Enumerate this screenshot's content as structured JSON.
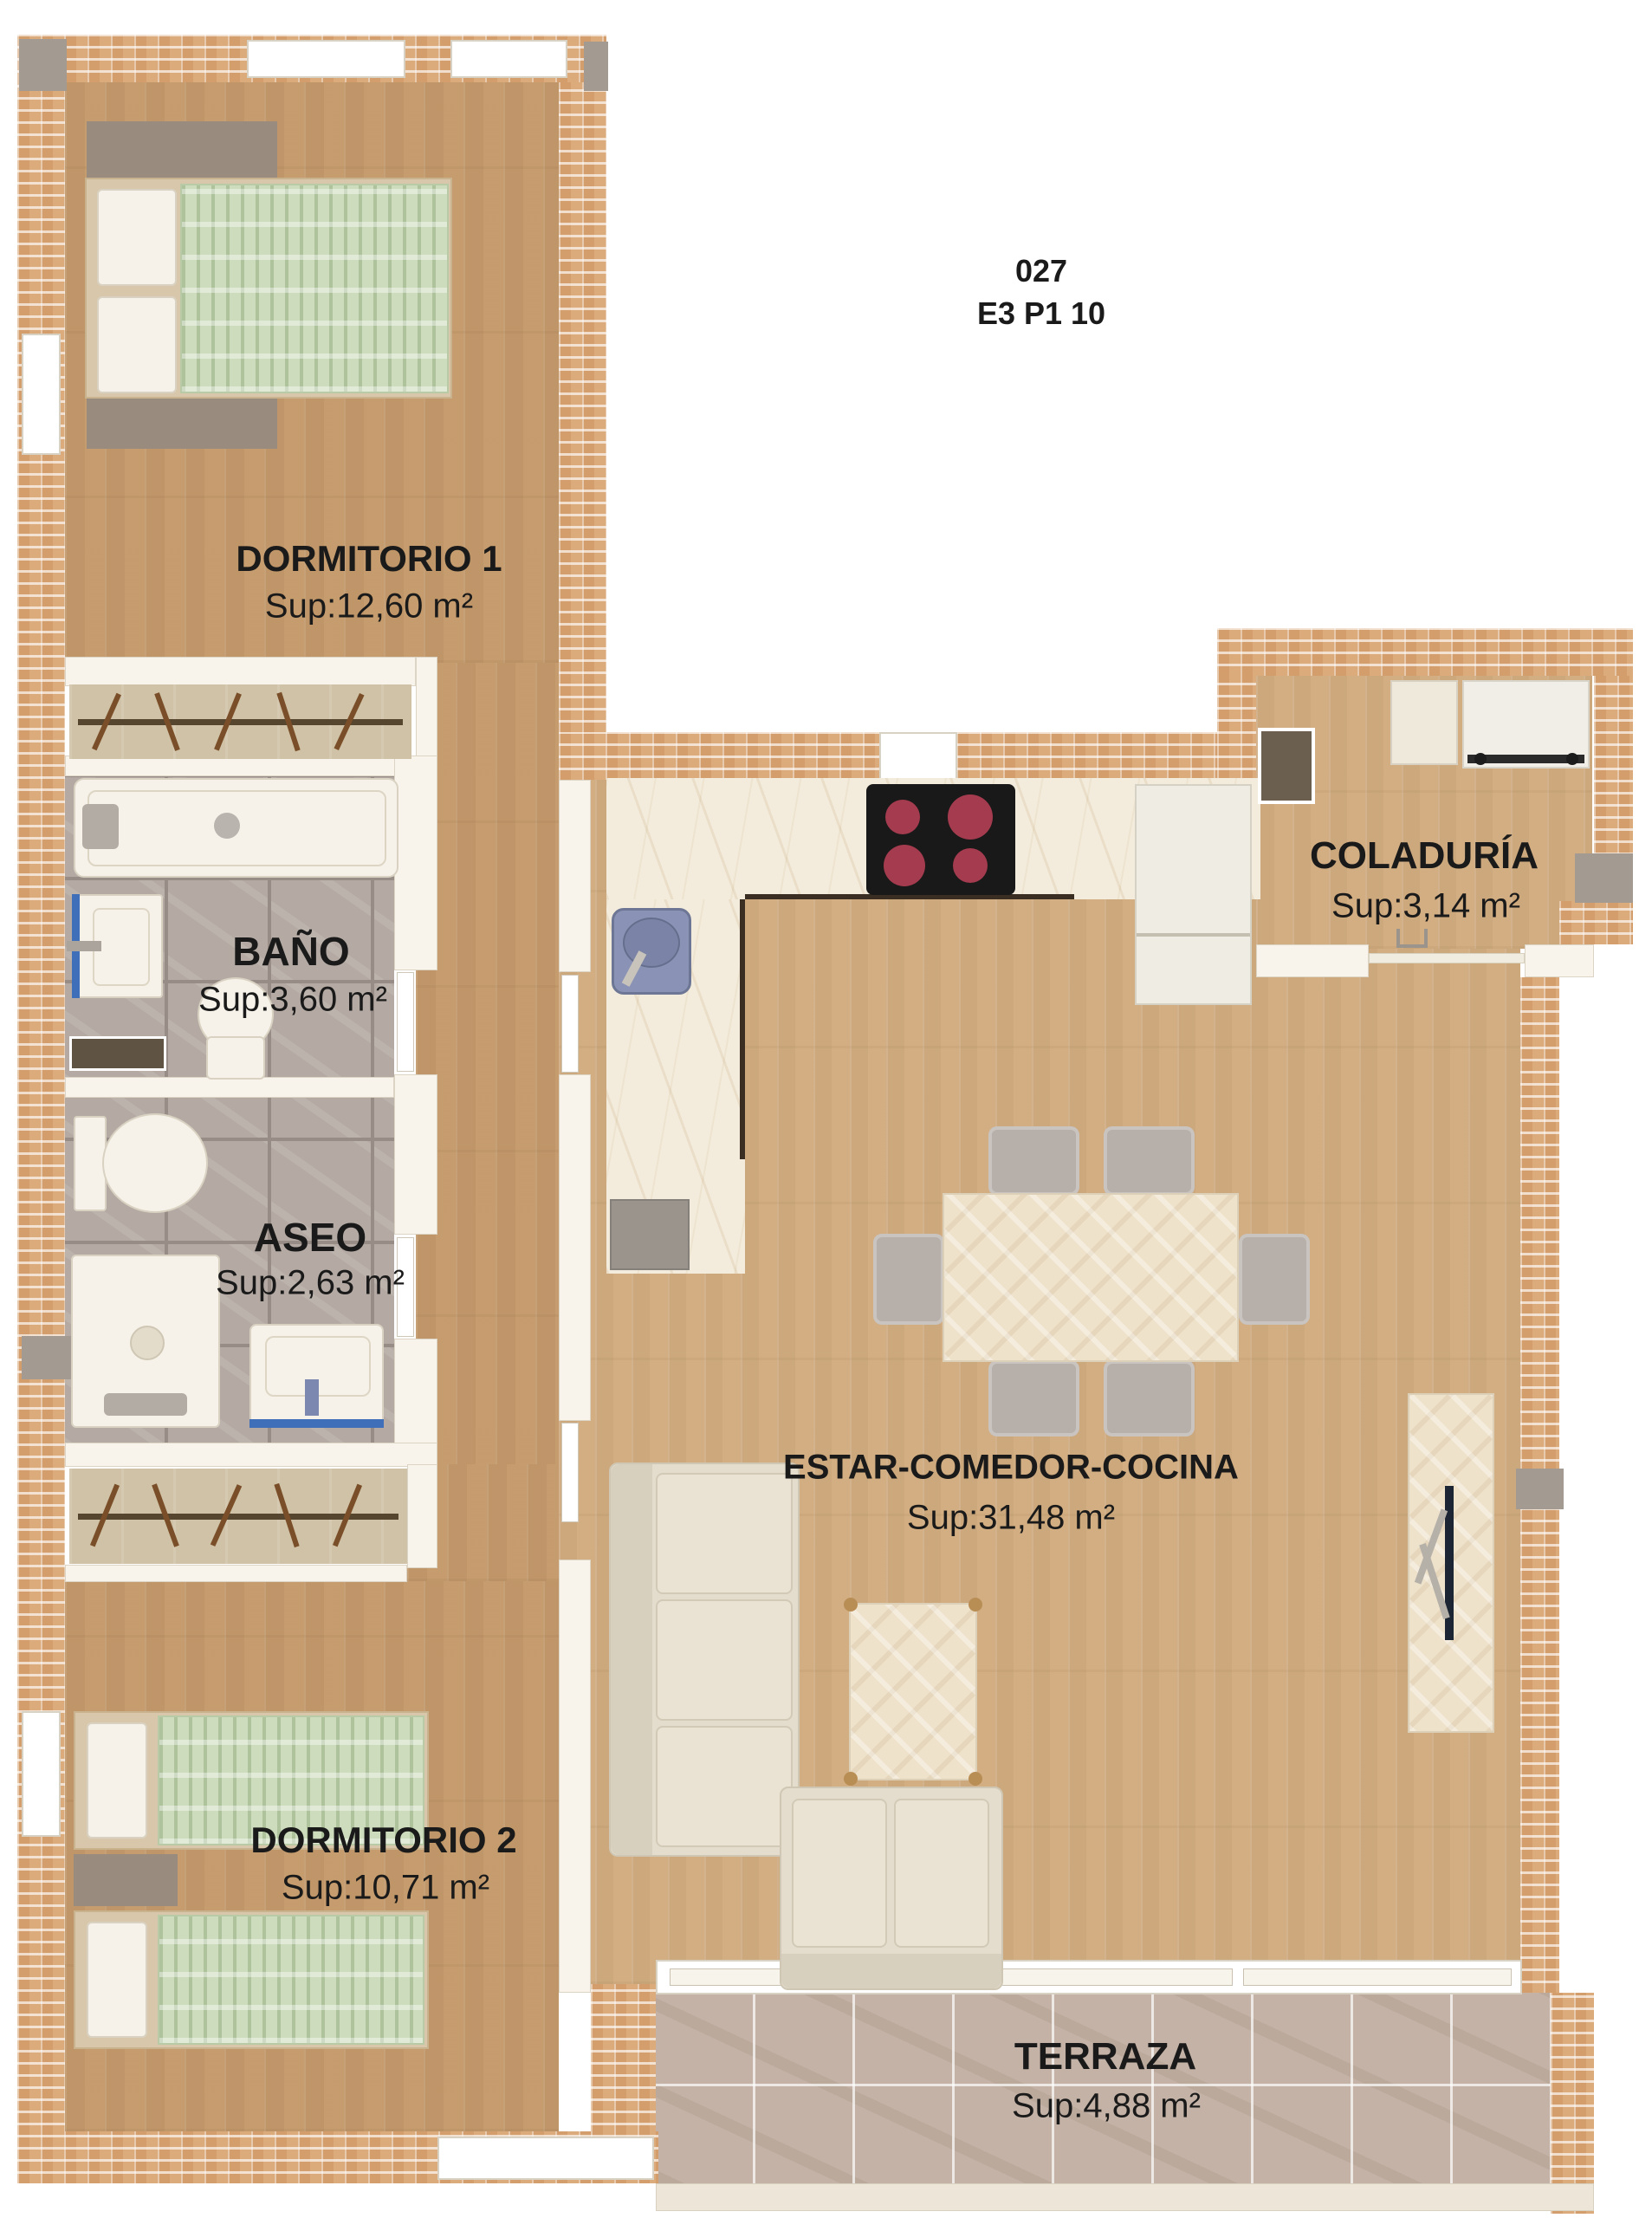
{
  "title": {
    "line1": "027",
    "line2": "E3 P1 10"
  },
  "rooms": [
    {
      "id": "dormitorio-1",
      "label": "DORMITORIO 1",
      "area": "Sup:12,60 m²"
    },
    {
      "id": "bano",
      "label": "BAÑO",
      "area": "Sup:3,60 m²"
    },
    {
      "id": "aseo",
      "label": "ASEO",
      "area": "Sup:2,63 m²"
    },
    {
      "id": "coladuria",
      "label": "COLADURÍA",
      "area": "Sup:3,14 m²"
    },
    {
      "id": "estar-comedor-cocina",
      "label": "ESTAR-COMEDOR-COCINA",
      "area": "Sup:31,48 m²"
    },
    {
      "id": "dormitorio-2",
      "label": "DORMITORIO 2",
      "area": "Sup:10,71 m²"
    },
    {
      "id": "terraza",
      "label": "TERRAZA",
      "area": "Sup:4,88 m²"
    }
  ],
  "palette": {
    "brick_wall": "#dcab7c",
    "wood_floor": "#c9a173",
    "bath_tile": "#b4aaa3",
    "terrace_tile": "#c3b2a5",
    "bed_cover_green": "#ccdcbc",
    "sink_blue": "#8a93b5",
    "label_text": "#1a1a1a"
  }
}
